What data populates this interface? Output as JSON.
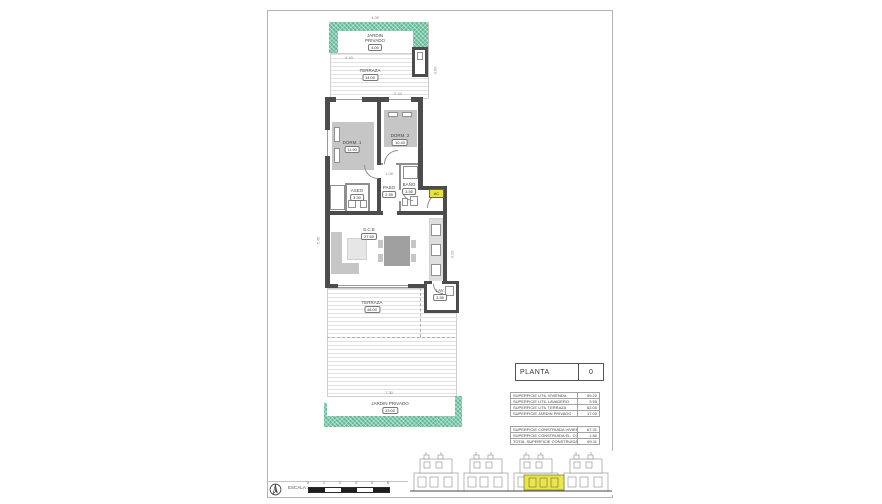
{
  "title_block": {
    "label": "PLANTA",
    "number": "0"
  },
  "rooms": {
    "jardin_top": {
      "label": "JARDIN PRIVADO",
      "value": "4.00"
    },
    "terraza_top": {
      "label": "TERRAZA",
      "value": "14.00"
    },
    "dorm1": {
      "label": "DORM. 1",
      "value": "11.90"
    },
    "dorm2": {
      "label": "DORM. 2",
      "value": "10.40"
    },
    "aseo": {
      "label": "ASEO",
      "value": "3.30"
    },
    "paso": {
      "label": "PASO",
      "value": "2.55"
    },
    "bano": {
      "label": "BAÑO",
      "value": "3.55"
    },
    "sce": {
      "label": "S.C.E",
      "value": "27.50"
    },
    "lav": {
      "label": "LAV.",
      "value": "3.55"
    },
    "terraza_bottom": {
      "label": "TERRAZA",
      "value": "48.00"
    },
    "jardin_bottom": {
      "label": "JARDIN PRIVADO",
      "value": "13.00"
    },
    "ac_unit": {
      "label": "AC"
    }
  },
  "dimensions": {
    "top": "4.05",
    "terraza_top_width": "4.40",
    "dorm2_width": "2.43",
    "hall": "1.08",
    "left_side": "5.45",
    "right_side": "3.20",
    "terraza_side": "3.60",
    "bottom": "7.30"
  },
  "surface_tables": {
    "util": {
      "rows": [
        {
          "label": "SUPERFICIE UTIL VIVIENDA",
          "value": "59.20"
        },
        {
          "label": "SUPERFICIE UTIL LAVADERO",
          "value": "3.55"
        },
        {
          "label": "SUPERFICIE UTIL TERRAZA",
          "value": "62.00"
        },
        {
          "label": "SUPERFICIE JARDIN PRIVADO",
          "value": "17.00"
        }
      ]
    },
    "construida": {
      "rows": [
        {
          "label": "SUPERFICIE CONSTRUIDA VIVIENDA",
          "value": "67.31"
        },
        {
          "label": "SUPERFICIE CONSTRUIDA EL. COMUNES",
          "value": "1.80"
        },
        {
          "label": "TOTAL SUPERFICIE CONSTRUIDA",
          "value": "69.11"
        }
      ]
    }
  },
  "scale_bar": {
    "label": "ESCALA :",
    "ticks": [
      "0",
      "1",
      "2",
      "3",
      "4",
      "5"
    ]
  },
  "colors": {
    "garden_green": "#5fb996",
    "wall_dark": "#4c4c4c",
    "unit_highlight": "#e9e43c"
  }
}
